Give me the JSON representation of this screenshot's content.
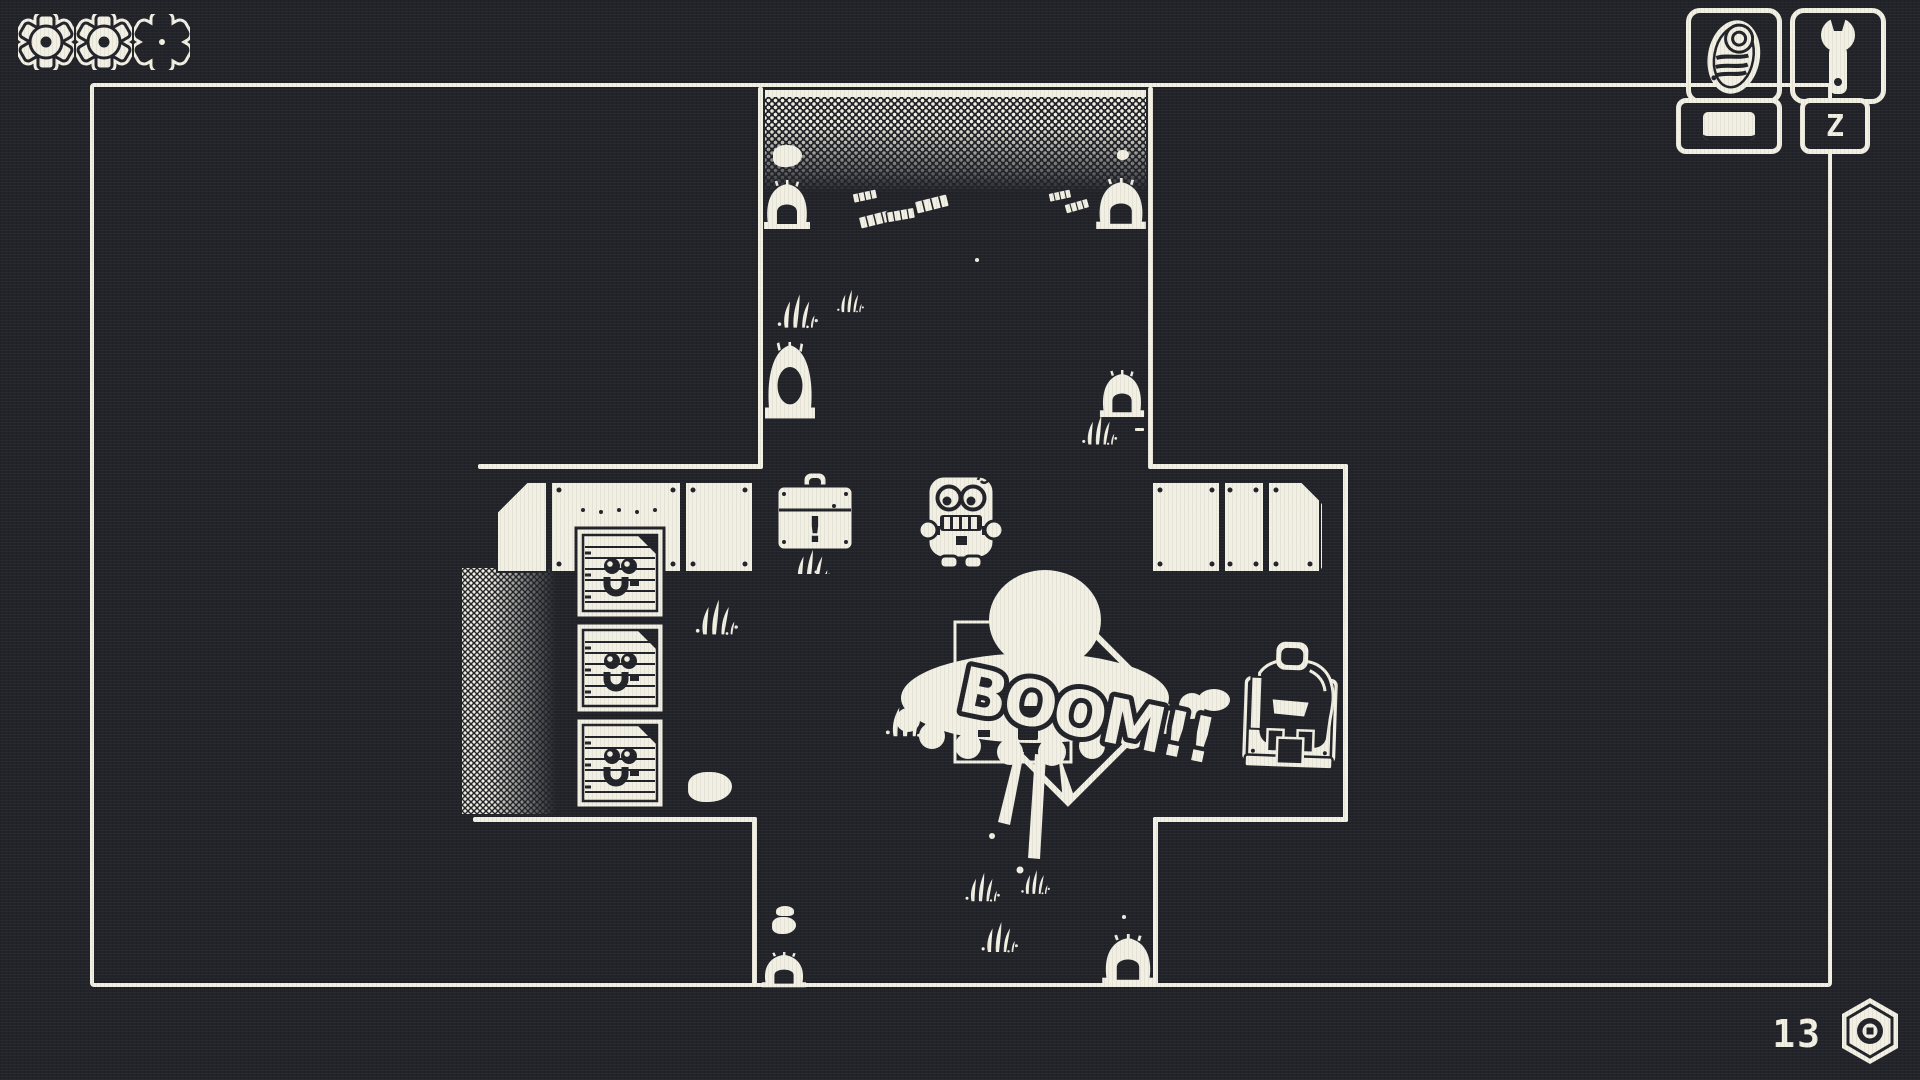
{
  "colors": {
    "background": "#212329",
    "foreground": "#f2efe3"
  },
  "hud": {
    "health": {
      "icon": "gear-icon",
      "gears": [
        {
          "state": "full"
        },
        {
          "state": "full"
        },
        {
          "state": "empty"
        }
      ]
    },
    "inventory": {
      "slots": [
        {
          "icon": "sneaker-icon",
          "keybind": "Space",
          "keybind_glyph": "spacebar-glyph"
        },
        {
          "icon": "wrench-icon",
          "keybind": "Z"
        }
      ]
    },
    "counter": {
      "value": "13",
      "icon": "hex-nut-icon"
    }
  },
  "scene": {
    "effect_text": "BOOM!!",
    "chest_mark": "!"
  }
}
